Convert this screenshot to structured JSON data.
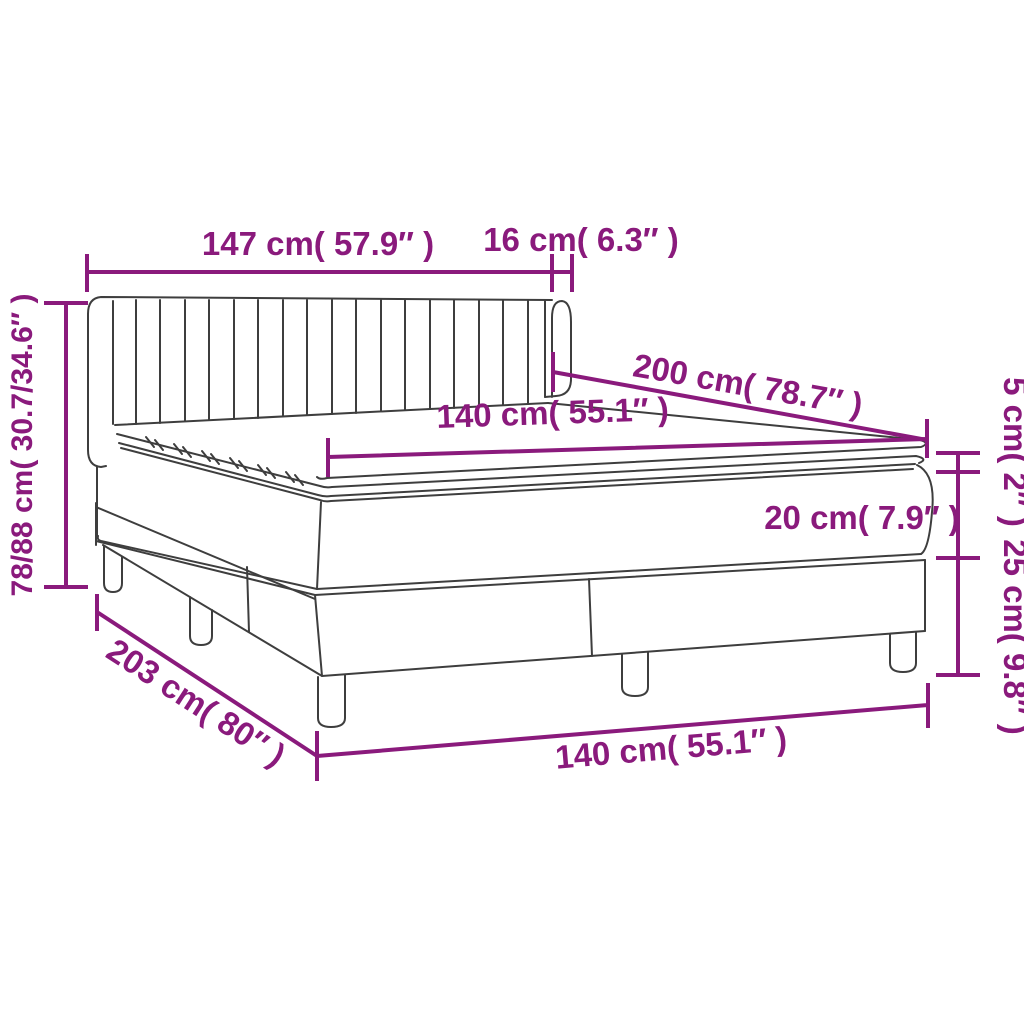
{
  "diagram": {
    "title": "box-spring-bed-dimension-diagram",
    "colors": {
      "dimension_accent": "#8A1A7C",
      "line_art": "#3E3E3E",
      "background": "#FFFFFF"
    },
    "labels": {
      "headboard_width": "147 cm( 57.9″ )",
      "headboard_depth": "16 cm( 6.3″ )",
      "total_height": "78/88 cm( 30.7/34.6″ )",
      "total_length": "203 cm( 80″ )",
      "bed_width": "140 cm( 55.1″ )",
      "mattress_width": "140 cm( 55.1″ )",
      "mattress_length": "200 cm( 78.7″ )",
      "topper_height": "5 cm( 2″ )",
      "mattress_height": "20 cm( 7.9″ )",
      "base_height": "25 cm( 9.8″ )"
    }
  }
}
